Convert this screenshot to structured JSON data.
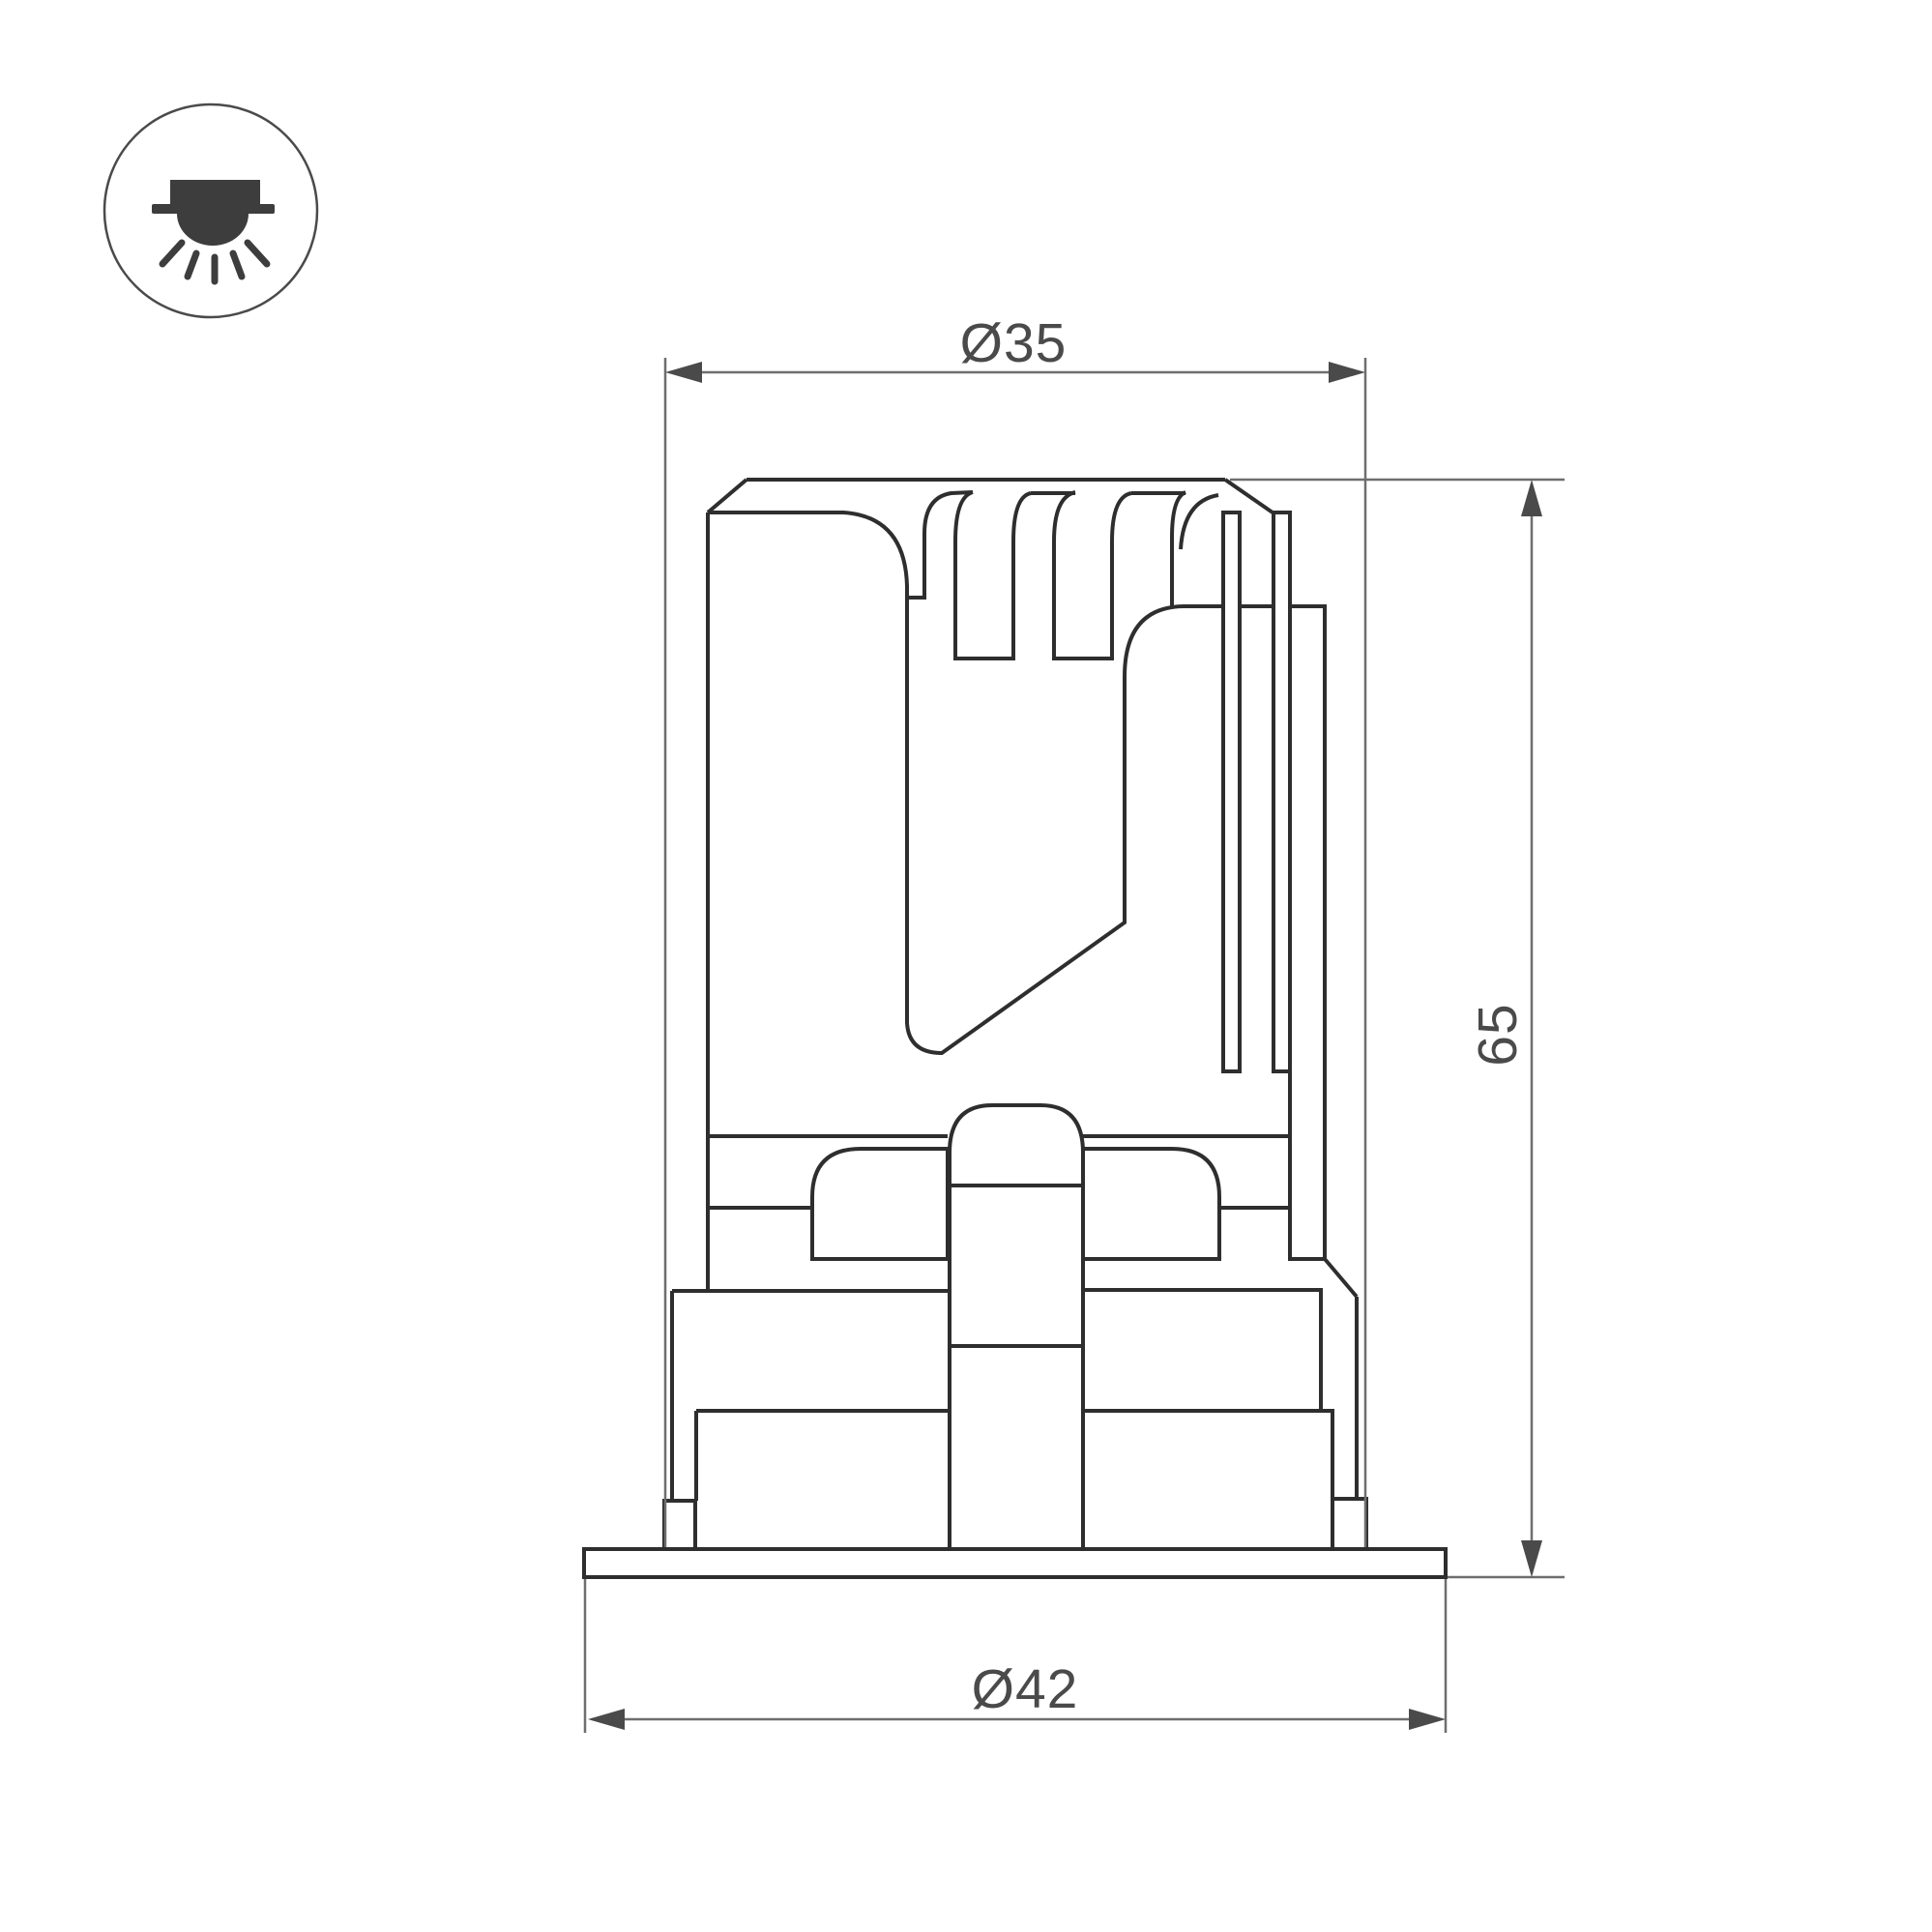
{
  "drawing": {
    "kind": "technical dimension drawing",
    "icon": "recessed-downlight-icon",
    "dimensions": {
      "top_diameter_label": "Ø35",
      "height_label": "65",
      "flange_diameter_label": "Ø42"
    },
    "colors": {
      "outline": "#2e2e2e",
      "dimension_line": "#6e6e6e",
      "label_text": "#4a4a4a",
      "icon_glyph": "#3d3d3d",
      "background": "#ffffff"
    }
  }
}
